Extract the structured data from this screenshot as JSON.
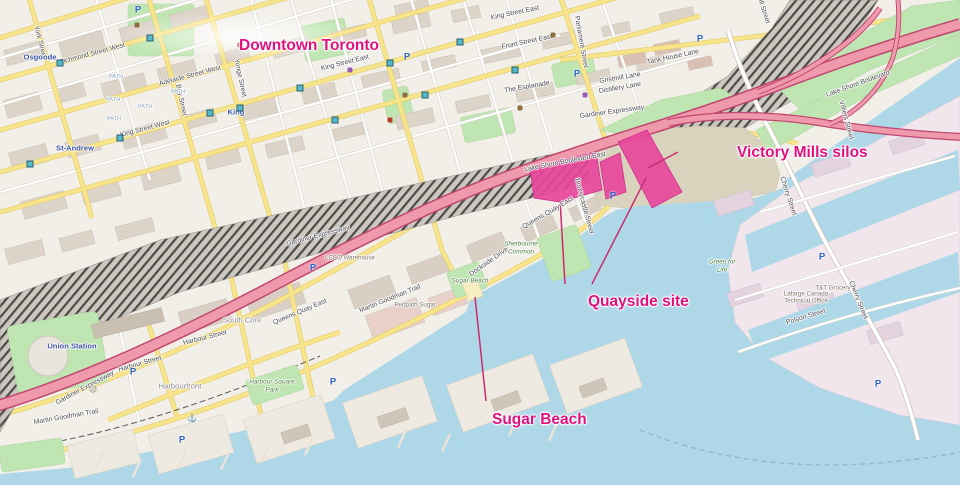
{
  "annotations": {
    "color": "#e0117f",
    "line_color": "#cc2b6e",
    "items": [
      {
        "id": "downtown-toronto",
        "text": "Downtown Toronto",
        "x": 239,
        "y": 37,
        "size": 15.5,
        "lines": []
      },
      {
        "id": "victory-mills-silos",
        "text": "Victory Mills silos",
        "x": 737,
        "y": 144,
        "size": 15.5,
        "lines": [
          [
            678,
            152,
            648,
            168
          ]
        ]
      },
      {
        "id": "quayside-site",
        "text": "Quayside site",
        "x": 588,
        "y": 293,
        "size": 15.5,
        "lines": [
          [
            565,
            284,
            560,
            200
          ],
          [
            592,
            284,
            646,
            178
          ]
        ]
      },
      {
        "id": "sugar-beach",
        "text": "Sugar Beach",
        "x": 492,
        "y": 411,
        "size": 15.5,
        "lines": [
          [
            486,
            401,
            475,
            297
          ]
        ]
      }
    ]
  },
  "map_labels": [
    {
      "t": "Richmond Street West",
      "x": 92,
      "y": 54,
      "r": -15,
      "c": "street"
    },
    {
      "t": "Adelaide Street West",
      "x": 190,
      "y": 76,
      "r": -15,
      "c": "street"
    },
    {
      "t": "King Street West",
      "x": 145,
      "y": 129,
      "r": -15,
      "c": "street"
    },
    {
      "t": "King Street East",
      "x": 345,
      "y": 63,
      "r": -14,
      "c": "street"
    },
    {
      "t": "King Street East",
      "x": 515,
      "y": 13,
      "r": -12,
      "c": "street"
    },
    {
      "t": "Front Street East",
      "x": 527,
      "y": 42,
      "r": -12,
      "c": "street"
    },
    {
      "t": "The Esplanade",
      "x": 527,
      "y": 87,
      "r": -10,
      "c": "street"
    },
    {
      "t": "Gardiner Expressway",
      "x": 85,
      "y": 388,
      "r": -28,
      "c": "street"
    },
    {
      "t": "Gardiner Expressway",
      "x": 318,
      "y": 236,
      "r": -15,
      "c": "street"
    },
    {
      "t": "Gardiner Expressway",
      "x": 612,
      "y": 112,
      "r": -8,
      "c": "street"
    },
    {
      "t": "Lake Shore Boulevard East",
      "x": 565,
      "y": 162,
      "r": -11,
      "c": "street"
    },
    {
      "t": "Lake Shore Boulevard",
      "x": 858,
      "y": 84,
      "r": -20,
      "c": "street"
    },
    {
      "t": "Queens Quay East",
      "x": 300,
      "y": 312,
      "r": -23,
      "c": "street"
    },
    {
      "t": "Queens Quay East",
      "x": 548,
      "y": 213,
      "r": -30,
      "c": "street"
    },
    {
      "t": "Harbour Street",
      "x": 140,
      "y": 364,
      "r": -16,
      "c": "street"
    },
    {
      "t": "Harbour Street",
      "x": 205,
      "y": 338,
      "r": -14,
      "c": "street"
    },
    {
      "t": "Yonge Street",
      "x": 240,
      "y": 78,
      "r": 78,
      "c": "street"
    },
    {
      "t": "Bay Street",
      "x": 181,
      "y": 100,
      "r": 78,
      "c": "street"
    },
    {
      "t": "York Street",
      "x": 40,
      "y": 42,
      "r": 75,
      "c": "street"
    },
    {
      "t": "Parliament Street",
      "x": 581,
      "y": 42,
      "r": 80,
      "c": "street"
    },
    {
      "t": "Cherry Street",
      "x": 788,
      "y": 196,
      "r": 72,
      "c": "street"
    },
    {
      "t": "Cherry Street",
      "x": 858,
      "y": 300,
      "r": 68,
      "c": "street"
    },
    {
      "t": "Villiers Street",
      "x": 846,
      "y": 120,
      "r": 75,
      "c": "street"
    },
    {
      "t": "Polson Street",
      "x": 806,
      "y": 317,
      "r": -17,
      "c": "street"
    },
    {
      "t": "Martin Goodman Trail",
      "x": 390,
      "y": 299,
      "r": -22,
      "c": "street"
    },
    {
      "t": "Martin Goodman Trail",
      "x": 66,
      "y": 417,
      "r": -10,
      "c": "street"
    },
    {
      "t": "Dockside Drive",
      "x": 489,
      "y": 262,
      "r": -35,
      "c": "street"
    },
    {
      "t": "Bonnycastle Street",
      "x": 584,
      "y": 206,
      "r": 75,
      "c": "street"
    },
    {
      "t": "Tank House Lane",
      "x": 673,
      "y": 57,
      "r": -12,
      "c": "street"
    },
    {
      "t": "Gristmill Lane",
      "x": 620,
      "y": 78,
      "r": -10,
      "c": "street"
    },
    {
      "t": "Distillery Lane",
      "x": 620,
      "y": 88,
      "r": -10,
      "c": "street"
    },
    {
      "t": "Mill Street",
      "x": 763,
      "y": 9,
      "r": 72,
      "c": "street"
    },
    {
      "t": "Union Station",
      "x": 72,
      "y": 346,
      "r": 0,
      "c": "station"
    },
    {
      "t": "Osgoode",
      "x": 40,
      "y": 57,
      "r": 0,
      "c": "station"
    },
    {
      "t": "St-Andrew",
      "x": 75,
      "y": 148,
      "r": 0,
      "c": "station"
    },
    {
      "t": "King",
      "x": 236,
      "y": 112,
      "r": 0,
      "c": "station"
    },
    {
      "t": "South Core",
      "x": 242,
      "y": 320,
      "r": 0,
      "c": "place"
    },
    {
      "t": "Harbourfront",
      "x": 180,
      "y": 386,
      "r": 0,
      "c": "place"
    },
    {
      "t": "LCBO Warehouse",
      "x": 350,
      "y": 258,
      "r": 0,
      "c": "building"
    },
    {
      "t": "Redpath Sugar",
      "x": 415,
      "y": 305,
      "r": 0,
      "c": "building"
    },
    {
      "t": "Sherbourne",
      "x": 521,
      "y": 244,
      "r": 0,
      "c": "park"
    },
    {
      "t": "Common",
      "x": 521,
      "y": 252,
      "r": 0,
      "c": "park"
    },
    {
      "t": "Sugar Beach",
      "x": 470,
      "y": 281,
      "r": 0,
      "c": "park"
    },
    {
      "t": "Harbour Square",
      "x": 272,
      "y": 382,
      "r": 0,
      "c": "park"
    },
    {
      "t": "Park",
      "x": 272,
      "y": 390,
      "r": 0,
      "c": "park"
    },
    {
      "t": "Green for",
      "x": 722,
      "y": 262,
      "r": 0,
      "c": "park"
    },
    {
      "t": "Life",
      "x": 722,
      "y": 270,
      "r": 0,
      "c": "park"
    },
    {
      "t": "Lafarge Canada",
      "x": 806,
      "y": 294,
      "r": 0,
      "c": "building"
    },
    {
      "t": "Technical Office",
      "x": 806,
      "y": 301,
      "r": 0,
      "c": "building"
    },
    {
      "t": "T&T Grocery",
      "x": 833,
      "y": 288,
      "r": 0,
      "c": "building"
    },
    {
      "t": "PATH",
      "x": 116,
      "y": 77,
      "r": 0,
      "c": "path"
    },
    {
      "t": "PATH",
      "x": 113,
      "y": 100,
      "r": 0,
      "c": "path"
    },
    {
      "t": "PATH",
      "x": 145,
      "y": 107,
      "r": 0,
      "c": "path"
    },
    {
      "t": "PATH",
      "x": 114,
      "y": 119,
      "r": 0,
      "c": "path"
    },
    {
      "t": "PATH",
      "x": 178,
      "y": 92,
      "r": 0,
      "c": "path"
    }
  ],
  "poi": {
    "parking_glyph": "P",
    "parking": [
      [
        138,
        10
      ],
      [
        407,
        57
      ],
      [
        577,
        74
      ],
      [
        700,
        39
      ],
      [
        613,
        196
      ],
      [
        313,
        268
      ],
      [
        333,
        382
      ],
      [
        822,
        257
      ],
      [
        878,
        384
      ],
      [
        182,
        440
      ],
      [
        133,
        372
      ]
    ],
    "transit_stops": [
      [
        30,
        164
      ],
      [
        120,
        138
      ],
      [
        210,
        113
      ],
      [
        300,
        88
      ],
      [
        390,
        63
      ],
      [
        60,
        63
      ],
      [
        150,
        38
      ],
      [
        335,
        120
      ],
      [
        425,
        95
      ],
      [
        515,
        70
      ],
      [
        240,
        108
      ],
      [
        460,
        42
      ]
    ],
    "amenity_dots": [
      {
        "x": 137,
        "y": 25,
        "c": "#8d6e3f"
      },
      {
        "x": 405,
        "y": 95,
        "c": "#8d6e3f"
      },
      {
        "x": 520,
        "y": 108,
        "c": "#8d6e3f"
      },
      {
        "x": 350,
        "y": 70,
        "c": "#9b59b6"
      },
      {
        "x": 585,
        "y": 95,
        "c": "#9b59b6"
      },
      {
        "x": 390,
        "y": 120,
        "c": "#c0392b"
      },
      {
        "x": 240,
        "y": 45,
        "c": "#c0392b"
      },
      {
        "x": 553,
        "y": 35,
        "c": "#8d6e3f"
      }
    ],
    "anchor_glyph": "⚓",
    "anchors": [
      [
        192,
        418
      ]
    ]
  },
  "colors": {
    "water": "#aed7e8",
    "land": "#f2efe9",
    "park_green": "#bfe6b2",
    "highlight_pink": "#e8479b",
    "motorway_pink": "#ee9aac",
    "motorway_casing": "#c0476f",
    "road_yellow": "#f8e48a",
    "annotation_magenta": "#e0117f",
    "beach_sand": "#f6eec0"
  }
}
